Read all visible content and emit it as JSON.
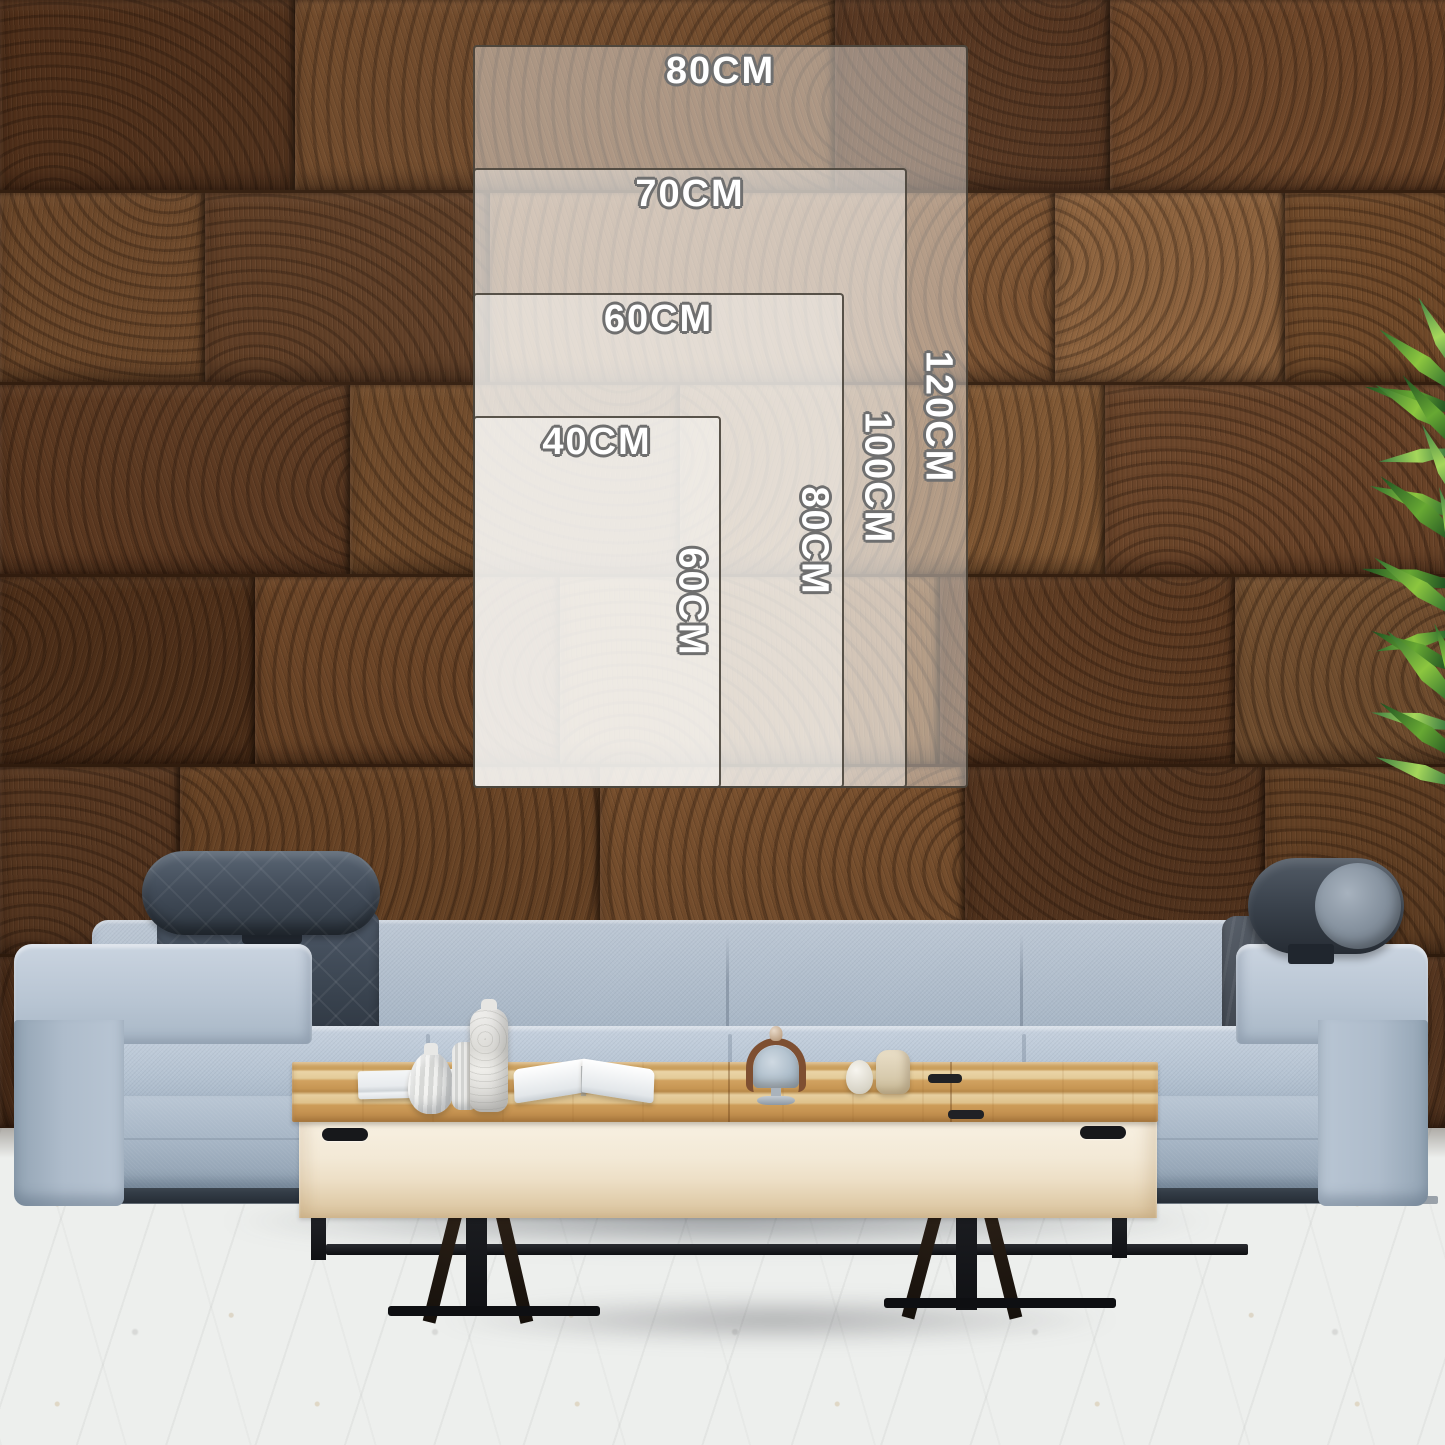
{
  "size_guide": {
    "unit": "CM",
    "sizes": [
      {
        "width_label": "40CM",
        "height_label": "60CM"
      },
      {
        "width_label": "60CM",
        "height_label": "80CM"
      },
      {
        "width_label": "70CM",
        "height_label": "100CM"
      },
      {
        "width_label": "80CM",
        "height_label": "120CM"
      }
    ]
  },
  "colors": {
    "overlay_fill": "rgba(253,252,251,0.42)",
    "overlay_border": "#3e3830",
    "label_fill": "#ffffff",
    "label_outline": "#6f6f6f",
    "wall_wood_base": "#6b4527",
    "sofa_fabric": "#aebccb",
    "sofa_dark_cushion": "#3a4450",
    "table_wood": "#d1a260",
    "floor": "#edefed",
    "plant_green": "#2c6b2e"
  }
}
